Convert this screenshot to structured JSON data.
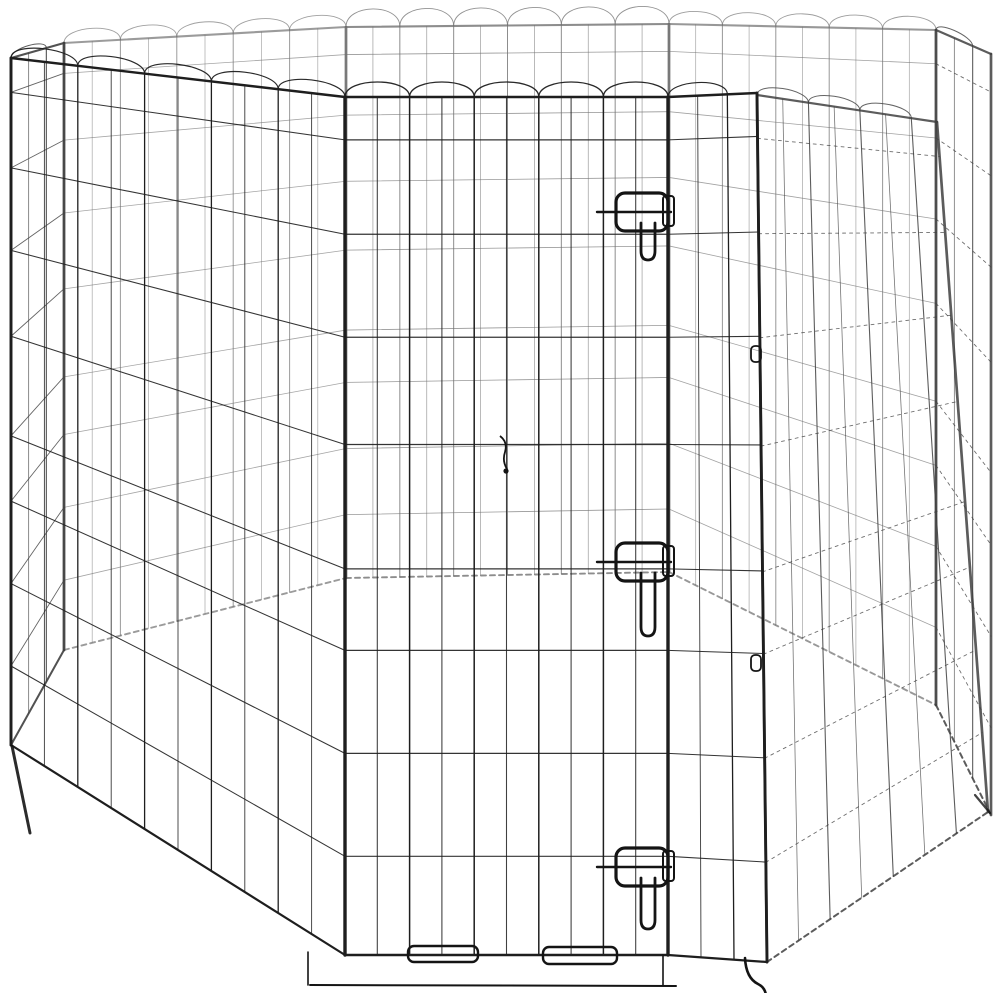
{
  "image": {
    "alt": "Eight-panel black metal wire pet exercise pen arranged in an octagon with a front door secured by slide-bolt latches",
    "background_color": "#ffffff",
    "wire_color": "#1e1e1e",
    "distant_wire_color": "#707070",
    "side_wire_color": "#3f3f3f",
    "hardware_color": "#141414",
    "panel_count": 8,
    "visible_latch_count": 3
  }
}
